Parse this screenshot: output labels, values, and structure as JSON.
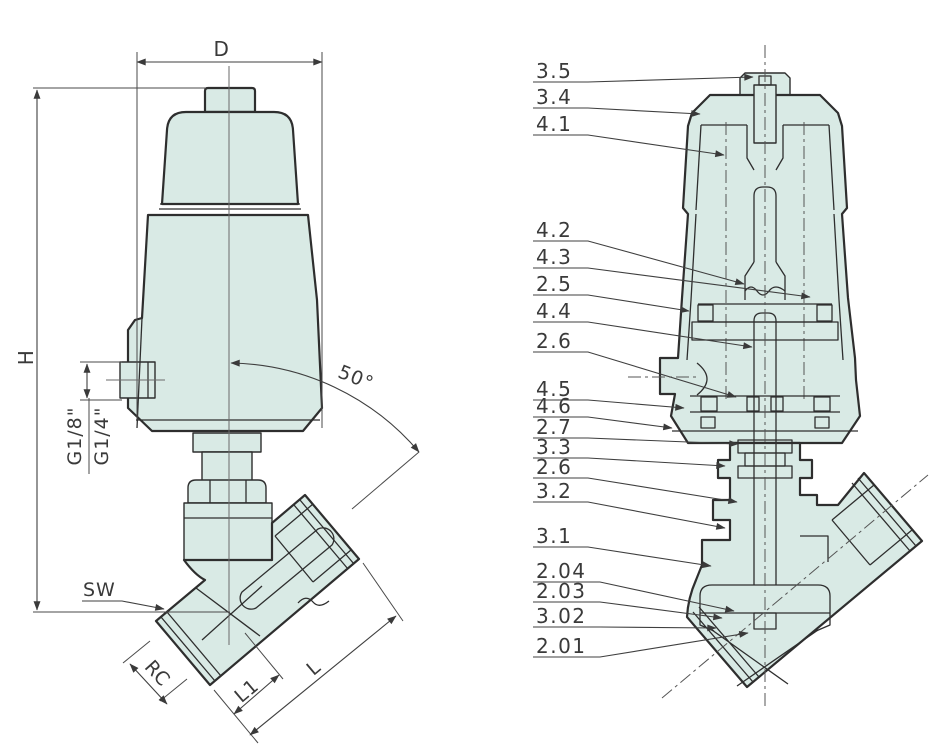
{
  "colors": {
    "background": "#ffffff",
    "part_fill": "#d9eae5",
    "outline": "#2e2e2e",
    "dimension_line": "#3f3f3f",
    "text": "#3a3a3a"
  },
  "left_view": {
    "labels": {
      "width_dim": "D",
      "height_dim": "H",
      "pilot_port_top": "G1/8\"",
      "pilot_port_bottom": "G1/4\"",
      "seat_angle": "50°",
      "wrench_size": "SW",
      "thread_size": "RC",
      "length_l1": "L1",
      "length_l": "L"
    }
  },
  "right_view": {
    "callouts": [
      {
        "label": "3.5"
      },
      {
        "label": "3.4"
      },
      {
        "label": "4.1"
      },
      {
        "label": "4.2"
      },
      {
        "label": "4.3"
      },
      {
        "label": "2.5"
      },
      {
        "label": "4.4"
      },
      {
        "label": "2.6"
      },
      {
        "label": "4.5"
      },
      {
        "label": "4.6"
      },
      {
        "label": "2.7"
      },
      {
        "label": "3.3"
      },
      {
        "label": "2.6"
      },
      {
        "label": "3.2"
      },
      {
        "label": "3.1"
      },
      {
        "label": "2.04"
      },
      {
        "label": "2.03"
      },
      {
        "label": "3.02"
      },
      {
        "label": "2.01"
      }
    ]
  }
}
